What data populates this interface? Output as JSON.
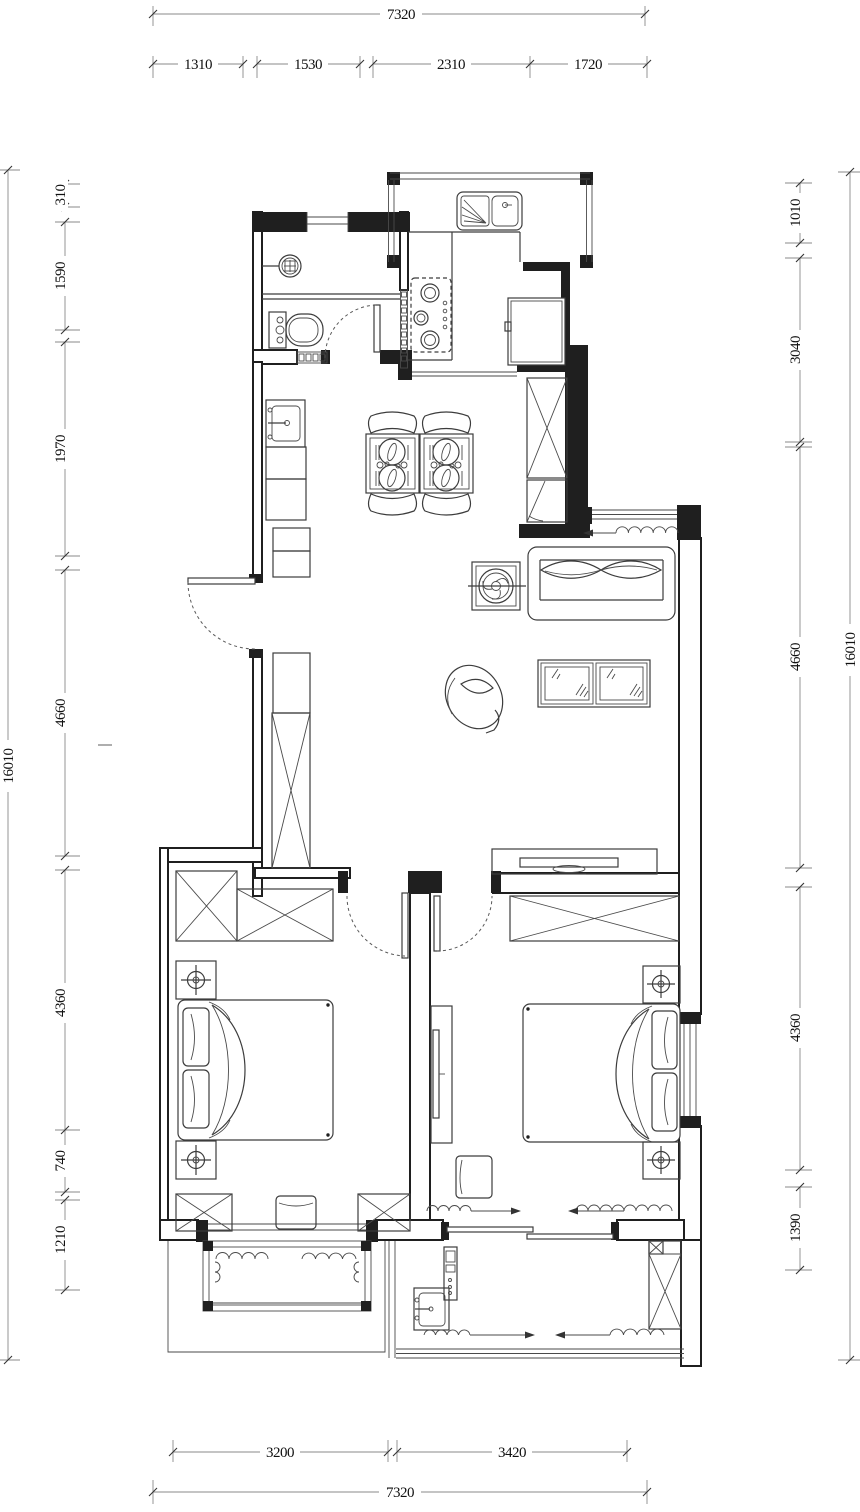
{
  "title": "apartment-floor-plan",
  "colors": {
    "ink": "#3c3c3c",
    "wall": "#1f1f1f",
    "dim": "#8a8a8a",
    "background": "#ffffff"
  },
  "dims": {
    "top_total": "7320",
    "top_segs": [
      "1310",
      "1530",
      "2310",
      "1720"
    ],
    "left_total": "16010",
    "left_segs": [
      "310",
      "1590",
      "1970",
      "4660",
      "4360",
      "740",
      "1210"
    ],
    "right_total": "16010",
    "right_segs": [
      "1010",
      "3040",
      "4660",
      "4360",
      "1390"
    ],
    "bottom_segs": [
      "3200",
      "3420"
    ],
    "bottom_total": "7320"
  }
}
